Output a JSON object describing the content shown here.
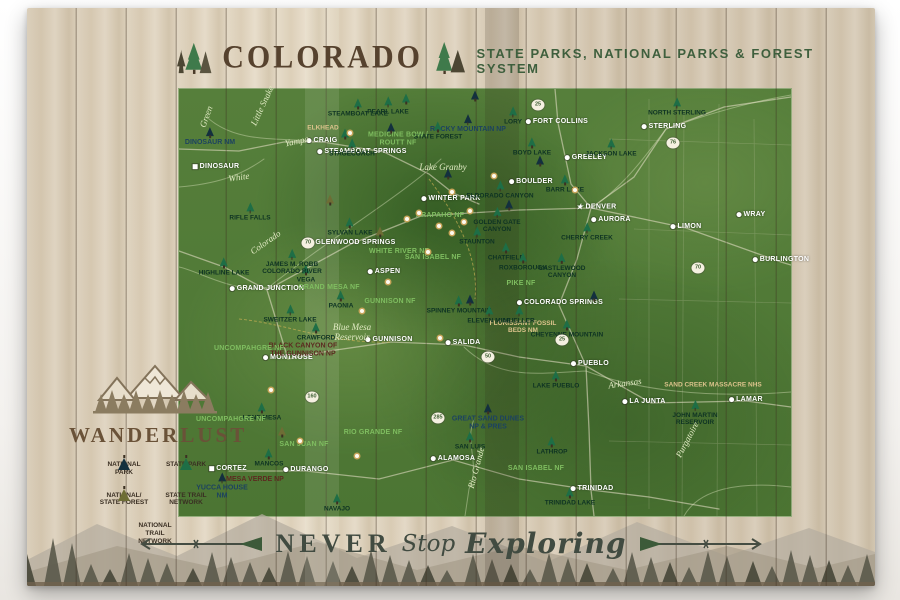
{
  "header": {
    "title": "COLORADO",
    "subtitle": "STATE PARKS, NATIONAL PARKS  & FOREST SYSTEM"
  },
  "footer": {
    "never": "NEVER",
    "stop": "Stop",
    "exploring": "Exploring"
  },
  "legend": {
    "brand": "WANDERLUST",
    "items": [
      {
        "label": "NATIONAL PARK",
        "icon": "tree-dark"
      },
      {
        "label": "STATE PARK",
        "icon": "tree-green"
      },
      {
        "label": "NATIONAL/\nSTATE FOREST",
        "icon": "tree-olive"
      },
      {
        "label": "STATE TRAIL\nNETWORK",
        "icon": "dash-gold"
      },
      {
        "label": "NATIONAL TRAIL\nNETWORK",
        "icon": "dot-dark"
      }
    ]
  },
  "colors": {
    "wood": "#ddd2bd",
    "map_green": "#4e7a35",
    "title_brown": "#56422e",
    "subtitle_green": "#3e5f3d",
    "state_park_tree": "#1e6e46",
    "national_park_tree": "#13303e",
    "forest_tree": "#6e6d35",
    "trail_gold": "#d2a93e",
    "footer_ink": "#414b41"
  },
  "map": {
    "labels": [
      {
        "t": "FORT COLLINS",
        "x": 557,
        "y": 122,
        "kind": "city"
      },
      {
        "t": "GREELEY",
        "x": 586,
        "y": 158,
        "kind": "city"
      },
      {
        "t": "STERLING",
        "x": 664,
        "y": 127,
        "kind": "city"
      },
      {
        "t": "BOULDER",
        "x": 531,
        "y": 182,
        "kind": "city"
      },
      {
        "t": "DENVER",
        "x": 596,
        "y": 207,
        "kind": "star"
      },
      {
        "t": "AURORA",
        "x": 611,
        "y": 220,
        "kind": "city"
      },
      {
        "t": "LIMON",
        "x": 686,
        "y": 227,
        "kind": "city"
      },
      {
        "t": "WRAY",
        "x": 751,
        "y": 215,
        "kind": "city"
      },
      {
        "t": "BURLINGTON",
        "x": 781,
        "y": 260,
        "kind": "city"
      },
      {
        "t": "GLENWOOD SPRINGS",
        "x": 352,
        "y": 243,
        "kind": "city"
      },
      {
        "t": "ASPEN",
        "x": 384,
        "y": 272,
        "kind": "city"
      },
      {
        "t": "GRAND JUNCTION",
        "x": 267,
        "y": 289,
        "kind": "city"
      },
      {
        "t": "MONTROSE",
        "x": 288,
        "y": 358,
        "kind": "city"
      },
      {
        "t": "GUNNISON",
        "x": 389,
        "y": 340,
        "kind": "city"
      },
      {
        "t": "SALIDA",
        "x": 463,
        "y": 343,
        "kind": "city"
      },
      {
        "t": "COLORADO SPRINGS",
        "x": 560,
        "y": 303,
        "kind": "city"
      },
      {
        "t": "PUEBLO",
        "x": 590,
        "y": 364,
        "kind": "city"
      },
      {
        "t": "LA JUNTA",
        "x": 644,
        "y": 402,
        "kind": "city"
      },
      {
        "t": "LAMAR",
        "x": 746,
        "y": 400,
        "kind": "city"
      },
      {
        "t": "ALAMOSA",
        "x": 453,
        "y": 459,
        "kind": "city"
      },
      {
        "t": "TRINIDAD",
        "x": 592,
        "y": 489,
        "kind": "city"
      },
      {
        "t": "DURANGO",
        "x": 306,
        "y": 470,
        "kind": "city"
      },
      {
        "t": "CORTEZ",
        "x": 228,
        "y": 469,
        "kind": "citysq"
      },
      {
        "t": "CRAIG",
        "x": 322,
        "y": 141,
        "kind": "city"
      },
      {
        "t": "DINOSAUR",
        "x": 216,
        "y": 167,
        "kind": "citysq"
      },
      {
        "t": "STEAMBOAT SPRINGS",
        "x": 362,
        "y": 152,
        "kind": "city"
      },
      {
        "t": "WINTER PARK",
        "x": 451,
        "y": 199,
        "kind": "city"
      },
      {
        "t": "DINOSAUR NM",
        "x": 210,
        "y": 137,
        "kind": "np"
      },
      {
        "t": "ROCKY MOUNTAIN NP",
        "x": 468,
        "y": 124,
        "kind": "np"
      },
      {
        "t": "GREAT SAND DUNES\nNP & PRES",
        "x": 488,
        "y": 417,
        "kind": "np"
      },
      {
        "t": "YUCCA HOUSE\nNM",
        "x": 222,
        "y": 486,
        "kind": "np"
      },
      {
        "t": "BLACK CANYON OF\nTHE GUNNISON NP",
        "x": 303,
        "y": 350,
        "kind": "npm"
      },
      {
        "t": "MESA VERDE NP",
        "x": 255,
        "y": 480,
        "kind": "npm"
      },
      {
        "t": "FLORISSANT FOSSIL\nBEDS NM",
        "x": 523,
        "y": 327,
        "kind": "tan"
      },
      {
        "t": "SAND CREEK MASSACRE NHS",
        "x": 713,
        "y": 385,
        "kind": "tan"
      },
      {
        "t": "ELKHEAD",
        "x": 323,
        "y": 128,
        "kind": "tan"
      },
      {
        "t": "NORTH STERLING",
        "x": 677,
        "y": 107,
        "kind": "sp"
      },
      {
        "t": "JACKSON LAKE",
        "x": 611,
        "y": 148,
        "kind": "sp"
      },
      {
        "t": "BARR LAKE",
        "x": 565,
        "y": 184,
        "kind": "sp"
      },
      {
        "t": "BOYD LAKE",
        "x": 532,
        "y": 147,
        "kind": "sp"
      },
      {
        "t": "LORY",
        "x": 513,
        "y": 116,
        "kind": "sp"
      },
      {
        "t": "STATE FOREST",
        "x": 438,
        "y": 131,
        "kind": "sp"
      },
      {
        "t": "ELDORADO CANYON",
        "x": 500,
        "y": 190,
        "kind": "sp"
      },
      {
        "t": "GOLDEN GATE\nCANYON",
        "x": 497,
        "y": 220,
        "kind": "sp"
      },
      {
        "t": "STAUNTON",
        "x": 477,
        "y": 236,
        "kind": "sp"
      },
      {
        "t": "CHATFIELD",
        "x": 506,
        "y": 252,
        "kind": "sp"
      },
      {
        "t": "ROXBOROUGH",
        "x": 523,
        "y": 262,
        "kind": "sp"
      },
      {
        "t": "CASTLEWOOD\nCANYON",
        "x": 562,
        "y": 266,
        "kind": "sp"
      },
      {
        "t": "CHERRY CREEK",
        "x": 587,
        "y": 232,
        "kind": "sp"
      },
      {
        "t": "SPINNEY MOUNTAIN",
        "x": 459,
        "y": 305,
        "kind": "sp"
      },
      {
        "t": "ELEVEN MILE",
        "x": 489,
        "y": 315,
        "kind": "sp"
      },
      {
        "t": "MUELLER",
        "x": 519,
        "y": 315,
        "kind": "sp"
      },
      {
        "t": "CHEYENNE MOUNTAIN",
        "x": 567,
        "y": 329,
        "kind": "sp"
      },
      {
        "t": "LAKE PUEBLO",
        "x": 556,
        "y": 380,
        "kind": "sp"
      },
      {
        "t": "LATHROP",
        "x": 552,
        "y": 446,
        "kind": "sp"
      },
      {
        "t": "TRINIDAD LAKE",
        "x": 570,
        "y": 497,
        "kind": "sp"
      },
      {
        "t": "SAN LUIS",
        "x": 470,
        "y": 441,
        "kind": "sp"
      },
      {
        "t": "NAVAJO",
        "x": 337,
        "y": 503,
        "kind": "sp"
      },
      {
        "t": "MANCOS",
        "x": 269,
        "y": 458,
        "kind": "sp"
      },
      {
        "t": "LONE MESA",
        "x": 262,
        "y": 412,
        "kind": "sp"
      },
      {
        "t": "CRAWFORD",
        "x": 316,
        "y": 332,
        "kind": "sp"
      },
      {
        "t": "SWEITZER LAKE",
        "x": 290,
        "y": 314,
        "kind": "sp"
      },
      {
        "t": "PAONIA",
        "x": 341,
        "y": 300,
        "kind": "sp"
      },
      {
        "t": "VEGA",
        "x": 306,
        "y": 274,
        "kind": "sp"
      },
      {
        "t": "HIGHLINE LAKE",
        "x": 224,
        "y": 267,
        "kind": "sp"
      },
      {
        "t": "JAMES M. ROBB\nCOLORADO RIVER",
        "x": 292,
        "y": 262,
        "kind": "sp"
      },
      {
        "t": "STEAMBOAT LAKE",
        "x": 358,
        "y": 108,
        "kind": "sp"
      },
      {
        "t": "PEARL LAKE",
        "x": 388,
        "y": 106,
        "kind": "sp"
      },
      {
        "t": "STAGECOACH",
        "x": 352,
        "y": 148,
        "kind": "sp"
      },
      {
        "t": "SYLVAN LAKE",
        "x": 350,
        "y": 227,
        "kind": "sp"
      },
      {
        "t": "RIFLE FALLS",
        "x": 250,
        "y": 212,
        "kind": "sp"
      },
      {
        "t": "JOHN MARTIN\nRESERVOIR",
        "x": 695,
        "y": 413,
        "kind": "sp"
      },
      {
        "t": "MEDICINE BOW /\nROUTT NF",
        "x": 398,
        "y": 139,
        "kind": "nf"
      },
      {
        "t": "ARAPAHO NF",
        "x": 440,
        "y": 216,
        "kind": "nf"
      },
      {
        "t": "WHITE RIVER NF",
        "x": 399,
        "y": 252,
        "kind": "nf"
      },
      {
        "t": "GRAND MESA NF",
        "x": 329,
        "y": 288,
        "kind": "nf"
      },
      {
        "t": "GUNNISON NF",
        "x": 390,
        "y": 302,
        "kind": "nf"
      },
      {
        "t": "UNCOMPAHGRE NF",
        "x": 249,
        "y": 349,
        "kind": "nf"
      },
      {
        "t": "UNCOMPAHGRE NF",
        "x": 231,
        "y": 420,
        "kind": "nf"
      },
      {
        "t": "SAN JUAN NF",
        "x": 304,
        "y": 445,
        "kind": "nf"
      },
      {
        "t": "RIO GRANDE NF",
        "x": 373,
        "y": 433,
        "kind": "nf"
      },
      {
        "t": "SAN ISABEL NF",
        "x": 433,
        "y": 258,
        "kind": "nf"
      },
      {
        "t": "SAN ISABEL NF",
        "x": 536,
        "y": 469,
        "kind": "nf"
      },
      {
        "t": "PIKE NF",
        "x": 521,
        "y": 284,
        "kind": "nf"
      },
      {
        "t": "Green",
        "x": 207,
        "y": 117,
        "kind": "river",
        "rot": -70
      },
      {
        "t": "Little Snake",
        "x": 263,
        "y": 106,
        "kind": "river",
        "rot": -65
      },
      {
        "t": "Yampa",
        "x": 297,
        "y": 142,
        "kind": "river",
        "rot": -12
      },
      {
        "t": "White",
        "x": 239,
        "y": 178,
        "kind": "river",
        "rot": -8
      },
      {
        "t": "Colorado",
        "x": 266,
        "y": 243,
        "kind": "river",
        "rot": -35
      },
      {
        "t": "Arkansas",
        "x": 625,
        "y": 384,
        "kind": "river",
        "rot": -8
      },
      {
        "t": "Rio Grande",
        "x": 477,
        "y": 468,
        "kind": "river",
        "rot": -75
      },
      {
        "t": "Purgatoire",
        "x": 688,
        "y": 440,
        "kind": "river",
        "rot": -62
      },
      {
        "t": "Lake Granby",
        "x": 443,
        "y": 168,
        "kind": "river"
      },
      {
        "t": "Blue Mesa\nReservoir",
        "x": 352,
        "y": 333,
        "kind": "river"
      }
    ],
    "trees": [
      {
        "x": 475,
        "y": 96,
        "k": "d"
      },
      {
        "x": 391,
        "y": 128,
        "k": "d"
      },
      {
        "x": 345,
        "y": 134,
        "k": "g"
      },
      {
        "x": 448,
        "y": 174,
        "k": "d"
      },
      {
        "x": 540,
        "y": 161,
        "k": "d"
      },
      {
        "x": 406,
        "y": 99,
        "k": "g"
      },
      {
        "x": 470,
        "y": 300,
        "k": "d"
      },
      {
        "x": 330,
        "y": 200,
        "k": "o"
      },
      {
        "x": 380,
        "y": 232,
        "k": "o"
      },
      {
        "x": 282,
        "y": 432,
        "k": "o"
      },
      {
        "x": 594,
        "y": 296,
        "k": "d"
      },
      {
        "x": 509,
        "y": 205,
        "k": "d"
      }
    ],
    "ski_markers": [
      [
        350,
        133
      ],
      [
        452,
        192
      ],
      [
        419,
        213
      ],
      [
        407,
        219
      ],
      [
        439,
        226
      ],
      [
        452,
        233
      ],
      [
        464,
        222
      ],
      [
        388,
        282
      ],
      [
        362,
        311
      ],
      [
        440,
        338
      ],
      [
        271,
        390
      ],
      [
        300,
        441
      ],
      [
        357,
        456
      ],
      [
        494,
        176
      ],
      [
        470,
        211
      ],
      [
        428,
        252
      ],
      [
        575,
        190
      ]
    ],
    "shields": [
      {
        "n": "25",
        "x": 538,
        "y": 105
      },
      {
        "n": "76",
        "x": 673,
        "y": 143
      },
      {
        "n": "70",
        "x": 698,
        "y": 268
      },
      {
        "n": "70",
        "x": 308,
        "y": 243
      },
      {
        "n": "50",
        "x": 488,
        "y": 357
      },
      {
        "n": "160",
        "x": 312,
        "y": 397
      },
      {
        "n": "285",
        "x": 438,
        "y": 418
      },
      {
        "n": "25",
        "x": 562,
        "y": 340
      }
    ]
  }
}
